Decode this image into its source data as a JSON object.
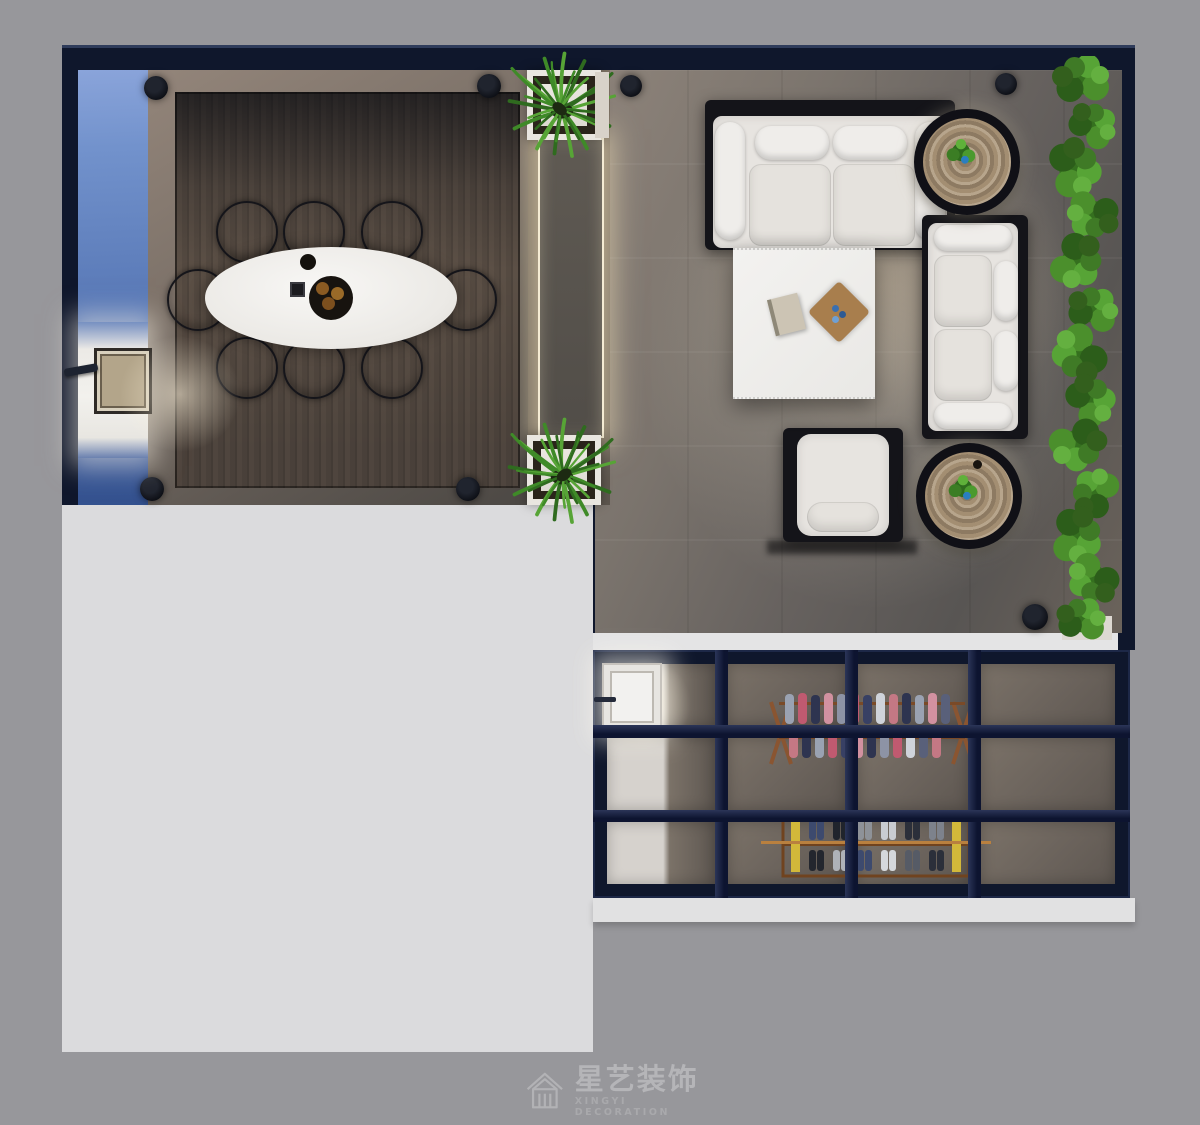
{
  "meta": {
    "kind": "3d-interior-top-view-rendering"
  },
  "watermark": {
    "icon": "house-logo-icon",
    "title": "星艺装饰",
    "subtitle": "XINGYI DECORATION"
  },
  "palette": {
    "background": "#97979b",
    "unrendered_area": "#dbdbdd",
    "wall": "#0f172c",
    "glass_blue": "#5878b6",
    "deck_wood": "#554a41",
    "marble_floor": "#7b746d",
    "upholstery": "#e7e4e0",
    "accent_green": "#3f7a2e",
    "warm_light": "#f5ecd4",
    "brass_rail": "#b9803f"
  },
  "scene": {
    "rooms": [
      {
        "name": "dining-terrace",
        "items": [
          "wood plank deck",
          "white oval dining table",
          "8 round beige dining chairs",
          "black round plate",
          "black square coaster",
          "round tray with 3 fruits",
          "blue glass side panel",
          "door niche with handle",
          "4 corner downlights"
        ]
      },
      {
        "name": "light-corridor",
        "items": [
          "illuminated stone panel with warm LED edge",
          "2 white planters with grass"
        ]
      },
      {
        "name": "living-room",
        "items": [
          "3-seat sofa",
          "2-seat sofa",
          "armchair",
          "square marble coffee table",
          "book",
          "diamond wood tray",
          "2 round wood-grain side tables with small plants",
          "vertical green hedge",
          "3 downlights"
        ]
      },
      {
        "name": "wardrobe-room",
        "items": [
          "navy glass grid partition 4x3",
          "white interior door",
          "clothes rack with hanging garments",
          "wooden shoe rack with shoe pairs",
          "brass rail"
        ]
      }
    ]
  }
}
